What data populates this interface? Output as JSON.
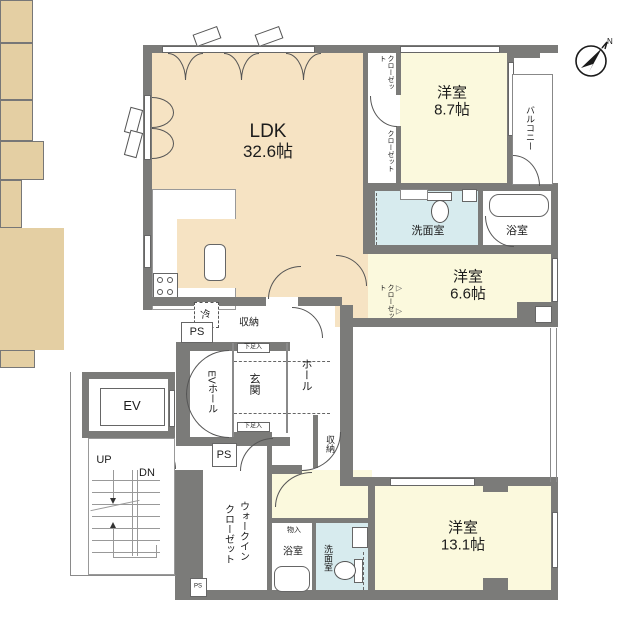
{
  "title": "apartment-floor-plan",
  "colors": {
    "wall": "#7b7b79",
    "ldk": "#f6e3c3",
    "bedroom": "#fbf9dd",
    "closet": "#e4cfa3",
    "wet": "#d7ebee",
    "thin": "#8a8a8a"
  },
  "labels": {
    "ldk_name": "LDK",
    "ldk_size": "32.6帖",
    "bedroom1_name": "洋室",
    "bedroom1_size": "8.7帖",
    "bedroom2_name": "洋室",
    "bedroom2_size": "6.6帖",
    "bedroom3_name": "洋室",
    "bedroom3_size": "13.1帖",
    "balcony": "バルコニー",
    "closet_top": "クローゼット",
    "closet_mid": "クローゼット",
    "closet_bed2": "クローゼット",
    "wic_line1": "ウォークイン",
    "wic_line2": "クローゼット",
    "washroom_top": "洗面室",
    "washroom_bottom": "洗面室",
    "bath_top": "浴室",
    "bath_bottom": "浴室",
    "storage_top": "収納",
    "storage_hall": "収納",
    "monoire": "物入",
    "shoe_top": "下足入",
    "shoe_bottom": "下足入",
    "genkan": "玄関",
    "hall": "ホール",
    "ev_hall": "EVホール",
    "ev": "EV",
    "fridge": "冷",
    "ps_top": "PS",
    "ps_mid": "PS",
    "ps_small": "PS",
    "up": "UP",
    "dn": "DN",
    "compass": "N"
  }
}
